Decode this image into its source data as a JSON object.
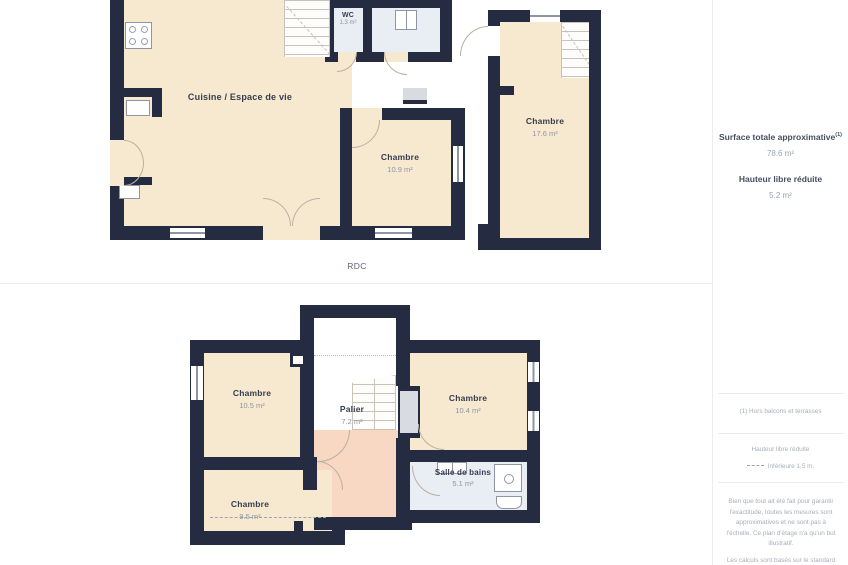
{
  "colors": {
    "wall": "#252b40",
    "room_cream": "#f7e9d0",
    "room_pink": "#f8d7c3",
    "room_blue": "#e9edf4",
    "closet_grey": "#d8dbe0",
    "line_grey": "#b9b0a2",
    "window_line": "#8e96a4",
    "divider": "#eaecef",
    "text_dark": "#363d4f",
    "text_muted": "#8d94a5",
    "text_note": "#a8aeba"
  },
  "floors": {
    "rdc": {
      "label": "RDC",
      "rooms": {
        "cuisine": {
          "name": "Cuisine / Espace de vie"
        },
        "wc": {
          "name": "WC",
          "area": "1.3 m²"
        },
        "chambre_1": {
          "name": "Chambre",
          "area": "10.9 m²"
        },
        "chambre_2": {
          "name": "Chambre",
          "area": "17.6 m²"
        }
      }
    },
    "etage": {
      "rooms": {
        "chambre_3": {
          "name": "Chambre",
          "area": "10.5 m²"
        },
        "palier": {
          "name": "Palier",
          "area": "7.2 m²"
        },
        "chambre_4": {
          "name": "Chambre",
          "area": "10.4 m²"
        },
        "chambre_5": {
          "name": "Chambre",
          "area": "9.5 m²"
        },
        "salle_de_bains": {
          "name": "Salle de bains",
          "area": "5.1 m²"
        }
      }
    }
  },
  "sidebar": {
    "surface_title": "Surface totale approximative",
    "surface_title_sup": "(1)",
    "surface_value": "78.6 m²",
    "height_title": "Hauteur libre réduite",
    "height_value": "5.2 m²",
    "footnote": "(1) Hors balcons et terrasses",
    "legend_title": "Hauteur libre réduite",
    "legend_item": "Inférieure 1,5 m.",
    "disclaimer": "Bien que tout ait été fait pour garantir l'exactitude, toutes les mesures sont approximatives et ne sont pas à l'échelle. Ce plan d'étage n'a qu'un but illustratif.",
    "footer": "Les calculs sont basés sur le standard"
  }
}
